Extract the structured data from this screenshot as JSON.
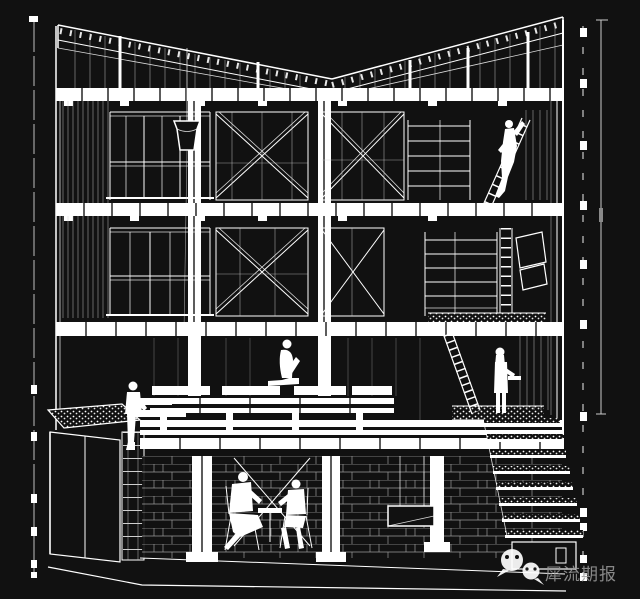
{
  "canvas": {
    "width": 640,
    "height": 599,
    "background": "#111111",
    "line_color": "#ffffff",
    "watermark_text_color": "#9a9a9a"
  },
  "drawing": {
    "type": "architectural section perspective",
    "style": "white wireframe line art on black background",
    "levels": [
      "butterfly roof with trussed rafters",
      "third floor with cross-braced bays and window grids",
      "second floor with cross-braced bays, shelving and loft",
      "ground floor with bench platform, planter and terrace",
      "basement with masonry wall, columns and seated figures"
    ],
    "elements": [
      "hanging bucket on plumb line",
      "ladders",
      "wide terraced stair at lower right",
      "dashed trim borders left and right",
      "vertical dimension line at right edge"
    ],
    "figures": 6
  },
  "watermark": {
    "icon": "wechat-icon",
    "text": "犀流期报"
  }
}
